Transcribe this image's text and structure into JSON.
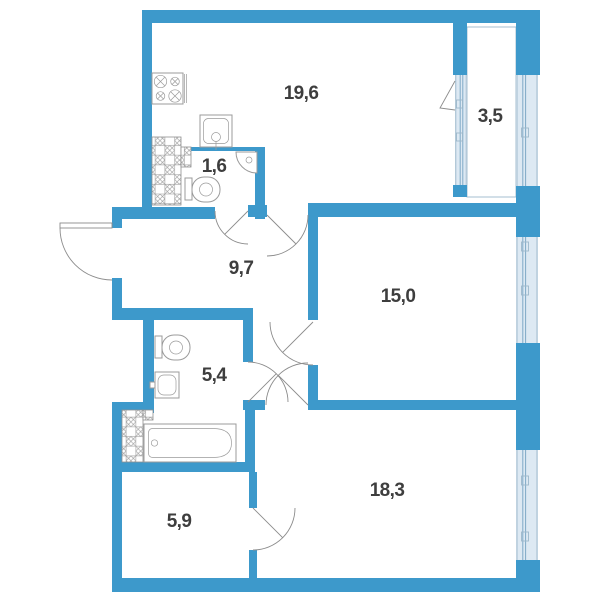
{
  "plan": {
    "type": "apartment-floor-plan",
    "colors": {
      "wall": "#3d99cb",
      "glass_fill": "#dde9f3",
      "glass_frame": "#9db8cb",
      "glass_mullion": "#7fa9c6",
      "fixture_outline": "#9b9b9b",
      "door_arc": "#8c8c8c",
      "label_text": "#3e3e3e"
    },
    "rooms": {
      "kitchen_living": {
        "area": "19,6"
      },
      "balcony": {
        "area": "3,5"
      },
      "wc": {
        "area": "1,6"
      },
      "hallway": {
        "area": "9,7"
      },
      "bedroom": {
        "area": "15,0"
      },
      "bathroom": {
        "area": "5,4"
      },
      "living_room": {
        "area": "18,3"
      },
      "storage": {
        "area": "5,9"
      }
    },
    "fixtures": {
      "stove": "stove-icon",
      "kitchen_sink": "kitchen-sink-icon",
      "corner_sink": "corner-sink-icon",
      "wc_toilet": "toilet-icon",
      "bath_toilet": "toilet-icon",
      "washbasin": "washbasin-icon",
      "bathtub": "bathtub-icon",
      "vent_shaft": "vent-shaft-icon"
    }
  }
}
